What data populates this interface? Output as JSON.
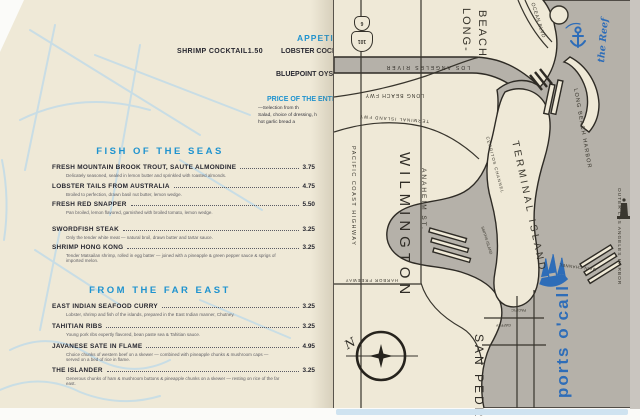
{
  "menu": {
    "top": {
      "shrimp_cocktail": {
        "name": "SHRIMP COCKTAIL",
        "price": "1.50"
      },
      "appetizers_heading_fragment": "APPETIZ",
      "lobster_line_fragment": "LOBSTER COCKT",
      "oyster_line_fragment": "BLUEPOINT OYST",
      "entree_heading_fragment": "PRICE OF THE ENTR",
      "entree_notes": [
        "—Selection from th",
        "Salad, choice of dressing, h",
        "hot garlic bread a"
      ]
    },
    "sections": [
      {
        "heading": "FISH OF THE SEAS",
        "items": [
          {
            "name": "FRESH MOUNTAIN BROOK TROUT, SAUTE ALMONDINE",
            "price": "3.75",
            "desc": "Delicately seasoned, sealed in lemon butter and sprinkled with roasted almonds."
          },
          {
            "name": "LOBSTER TAILS FROM AUSTRALIA",
            "price": "4.75",
            "desc": "Broiled to perfection, drawn basil nut butter, lemon wedge."
          },
          {
            "name": "FRESH RED SNAPPER",
            "price": "5.50",
            "desc": "Pan broiled, lemon flavored, garnished with broiled tomato, lemon wedge."
          },
          {
            "name": "SWORDFISH STEAK",
            "price": "3.25",
            "desc": "Only the tender white meat — natural broil, drawn butter and tartar sauce."
          },
          {
            "name": "SHRIMP HONG KONG",
            "price": "3.25",
            "desc": "Tender Matsailan shrimp, rolled in egg batter — joined with a pineapple & green pepper sauce & sprigs of imported melon."
          }
        ]
      },
      {
        "heading": "FROM THE FAR EAST",
        "items": [
          {
            "name": "EAST INDIAN SEAFOOD CURRY",
            "price": "3.25",
            "desc": "Lobster, shrimp and fish of the islands, prepared in the East Indian manner, Chutney."
          },
          {
            "name": "TAHITIAN RIBS",
            "price": "3.25",
            "desc": "Young pork ribs expertly flavored, bean paste sea & Tahitian sauce."
          },
          {
            "name": "JAVANESE SATE IN FLAME",
            "price": "4.95",
            "desc": "Choice chunks of western beef on a skewer — combined with pineapple chunks & mushroom caps — served on a bed of rice in flame."
          },
          {
            "name": "THE ISLANDER",
            "price": "3.25",
            "desc": "Generous chunks of ham & mushroom buttons & pineapple chunks on a skewer — resting on rice of the far east."
          }
        ]
      }
    ]
  },
  "map": {
    "labels": {
      "long_beach_line1": "LONG-",
      "long_beach_line2": "BEACH",
      "ocean_blvd": "OCEAN BLVD",
      "the_reef": "the Reef",
      "los_angeles_river": "LOS ANGELES RIVER",
      "long_beach_fwy": "LONG BEACH FWY",
      "terminal_island_fwy": "TERMINAL ISLAND FWY",
      "pacific_coast_highway": "PACIFIC COAST HIGHWAY",
      "wilmington": "WILMINGTON",
      "anaheim_st": "ANAHEIM ST.",
      "terminal_island": "TERMINAL ISLAND",
      "cerritos_channel": "CERRITOS CHANNEL",
      "smiths_island": "SMITHS ISLAND",
      "long_beach_harbor": "LONG BEACH HARBOR",
      "outer_los_angeles_harbor": "OUTER LOS ANGELES HARBOR",
      "main_channel": "MAIN CHANNEL",
      "san_pedro": "SAN PEDRO",
      "ports_o_call": "ports o'call",
      "harbor_freeway": "HARBOR FREEWAY",
      "pacific_st": "PACIFIC",
      "gaffey_st": "GAFFEY",
      "compass_n": "N"
    },
    "route_shields": {
      "top": "6",
      "bottom": "101"
    }
  },
  "colors": {
    "heading_blue": "#1f93cf",
    "ink_navy": "#26262f",
    "map_accent_blue": "#2e6db8",
    "water_gray": "#b5b1a9",
    "paper_cream": "#efe9d7"
  }
}
